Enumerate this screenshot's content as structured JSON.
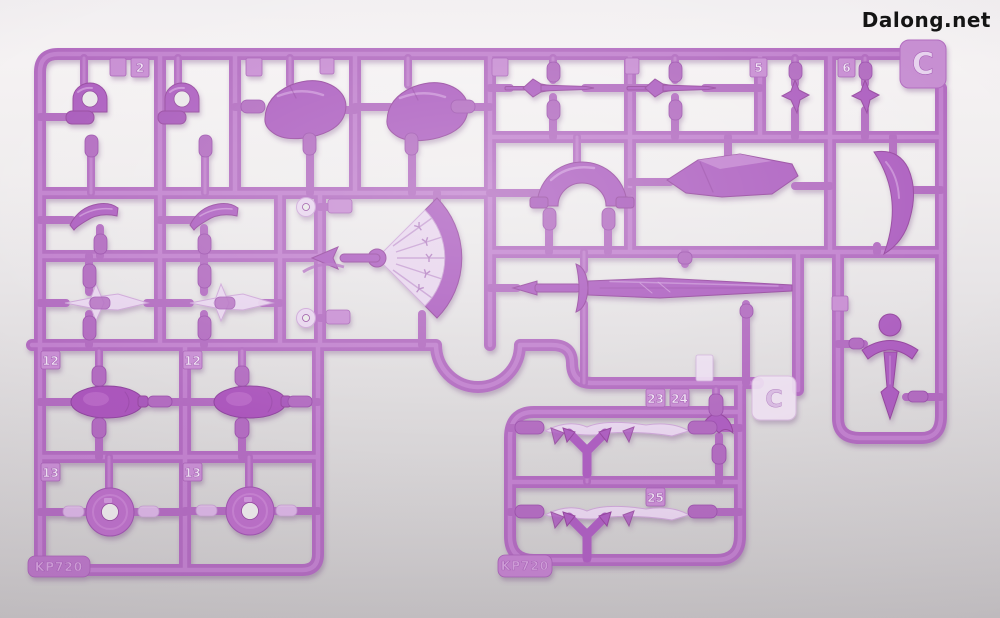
{
  "watermark": {
    "text": "Dalong.net",
    "color": "#141414"
  },
  "runner": {
    "letter_tabs": [
      {
        "label": "C"
      },
      {
        "label": "C"
      }
    ],
    "mold_marks": [
      {
        "label": "KP720"
      },
      {
        "label": "KP720"
      }
    ],
    "part_tags": [
      {
        "label": "2"
      },
      {
        "label": "5"
      },
      {
        "label": "6"
      },
      {
        "label": "12"
      },
      {
        "label": "12"
      },
      {
        "label": "13"
      },
      {
        "label": "13"
      },
      {
        "label": "23"
      },
      {
        "label": "24"
      },
      {
        "label": "25"
      }
    ],
    "colors": {
      "plastic_main": "#b26cc0",
      "plastic_dark": "#96489f",
      "plastic_light": "#cd93d8",
      "translucent": "#ead7f0",
      "background_top": "#f5f2f3",
      "background_bottom": "#c7c4c6"
    }
  }
}
